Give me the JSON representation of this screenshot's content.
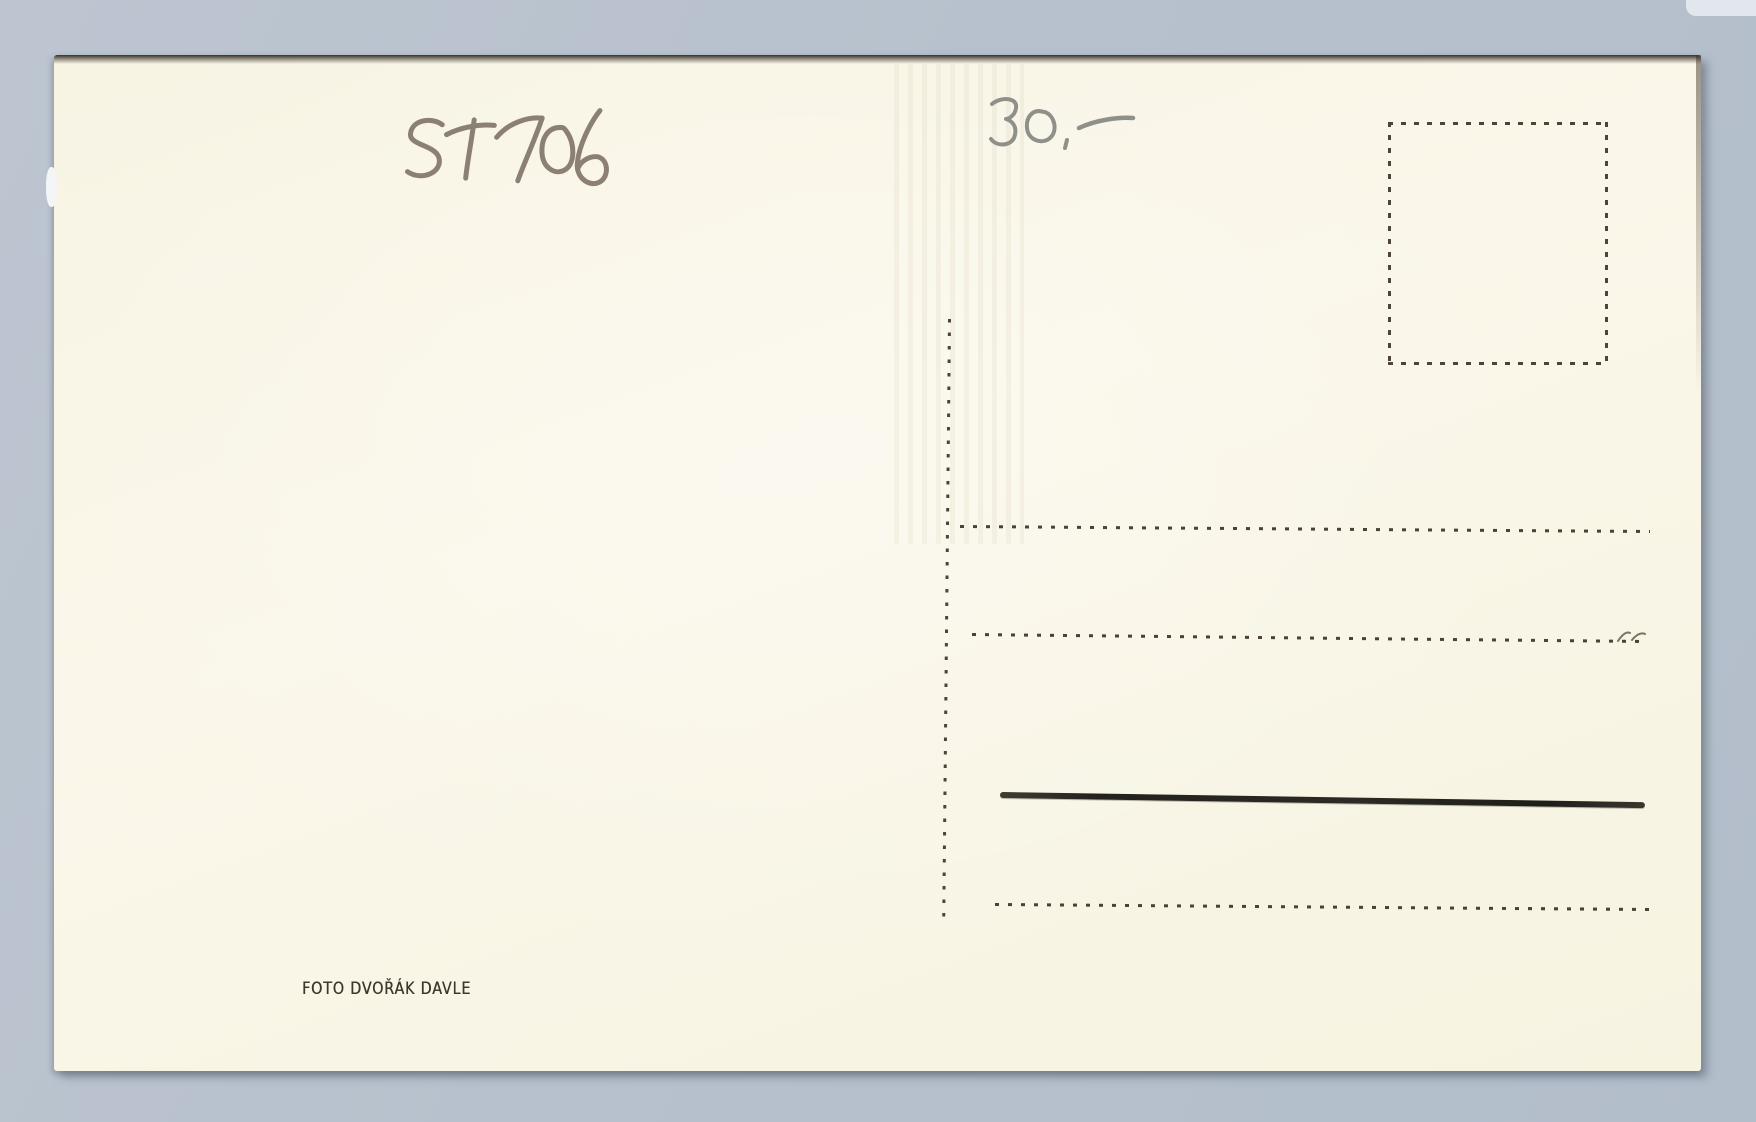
{
  "scene": {
    "object": "postcard-back-photograph",
    "background_color": "#b7c1cd",
    "card_color": "#f8f4e5",
    "ink_color": "#4b4136",
    "pencil_color": "#8b8073"
  },
  "postcard": {
    "handwritten": {
      "catalog_number": "ST706",
      "price": "30.-"
    },
    "publisher_imprint": "FOTO DVOŘÁK DAVLE",
    "stamp_box": {
      "name": "stamp-box",
      "style": "dotted-outline",
      "content": ""
    },
    "address_area": {
      "divider": "vertical-dotted-line",
      "lines": [
        {
          "style": "dotted",
          "content": ""
        },
        {
          "style": "dotted",
          "content": ""
        },
        {
          "style": "solid-marker",
          "content": ""
        },
        {
          "style": "dotted",
          "content": ""
        }
      ]
    }
  }
}
